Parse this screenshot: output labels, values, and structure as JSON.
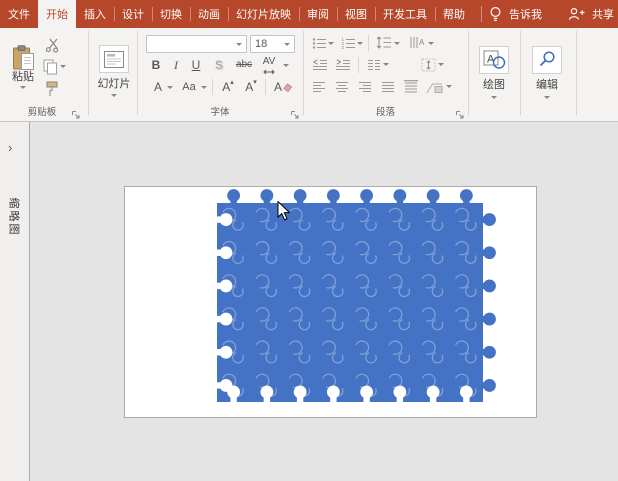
{
  "colors": {
    "ribbon_red": "#B7472A",
    "puzzle_blue": "#4472C4",
    "seam": "rgba(255,255,255,0.33)",
    "accent_blue": "#3C6CC0"
  },
  "tabs": [
    {
      "id": "file",
      "label": "文件",
      "selected": false
    },
    {
      "id": "home",
      "label": "开始",
      "selected": true
    },
    {
      "id": "insert",
      "label": "插入",
      "selected": false
    },
    {
      "id": "design",
      "label": "设计",
      "selected": false
    },
    {
      "id": "transitions",
      "label": "切换",
      "selected": false
    },
    {
      "id": "animations",
      "label": "动画",
      "selected": false
    },
    {
      "id": "slideshow",
      "label": "幻灯片放映",
      "selected": false
    },
    {
      "id": "review",
      "label": "审阅",
      "selected": false
    },
    {
      "id": "view",
      "label": "视图",
      "selected": false
    },
    {
      "id": "developer",
      "label": "开发工具",
      "selected": false
    },
    {
      "id": "help",
      "label": "帮助",
      "selected": false
    }
  ],
  "tell_me": {
    "label": "告诉我",
    "icon": "lightbulb-icon"
  },
  "share": {
    "label": "共享",
    "icon": "person-add-icon"
  },
  "ribbon": {
    "clipboard": {
      "group_label": "剪贴板",
      "paste_label": "粘贴",
      "icons": [
        "clipboard-icon",
        "scissors-icon",
        "copy-icon",
        "format-painter-icon",
        "dialog-launcher-icon"
      ]
    },
    "slides": {
      "button_label": "幻灯片",
      "icon": "new-slide-icon"
    },
    "font": {
      "group_label": "字体",
      "name_value": "",
      "size_value": "18",
      "bold": "B",
      "italic": "I",
      "underline": "U",
      "shadow": "S",
      "strikethrough": "abc",
      "spacing": "AV",
      "color": "A",
      "case": "Aa",
      "grow": "A",
      "shrink": "A",
      "clear": "A"
    },
    "paragraph": {
      "group_label": "段落"
    },
    "drawing": {
      "button_label": "绘图",
      "icon": "drawing-icon"
    },
    "editing": {
      "button_label": "编辑",
      "icon": "search-icon"
    }
  },
  "thumbnail_panel": {
    "chevron": "›",
    "vertical_label": "缩略图"
  },
  "canvas": {
    "puzzle": {
      "cols": 8,
      "rows": 6,
      "color": "#4472C4",
      "seam_color": "rgba(255,255,255,0.33)",
      "edges": {
        "top": "knobs",
        "right": "knobs",
        "bottom": "sockets",
        "left": "sockets"
      }
    }
  }
}
